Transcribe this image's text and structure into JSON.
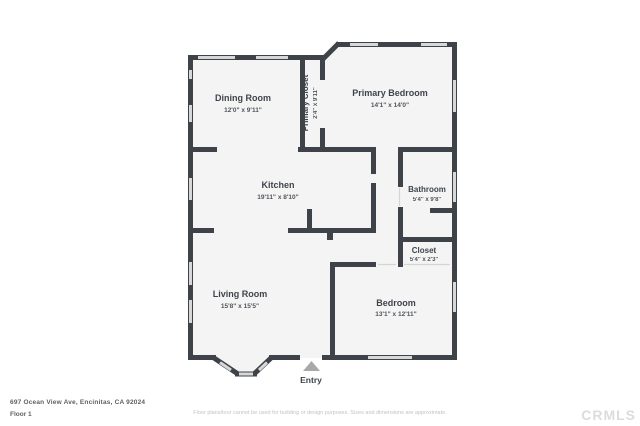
{
  "meta": {
    "address": "697 Ocean View Ave, Encinitas, CA 92024",
    "floor_label": "Floor 1",
    "disclaimer": "Floor plans/tour cannot be used for building or design purposes. Sizes and dimensions are approximate.",
    "watermark": "CRMLS"
  },
  "colors": {
    "wall": "#3e434a",
    "floor": "#f4f4f4",
    "window": "#d8d8d8",
    "label": "#3f444b",
    "entry_marker": "#a8a8a8",
    "disclaimer": "#c2c2c2",
    "watermark": "#dcdcdc"
  },
  "rooms": {
    "dining": {
      "name": "Dining Room",
      "dims": "12'0\" x 9'11\""
    },
    "primary_closet": {
      "name": "Primary Closet",
      "dims": "2'4\" x 9'11\""
    },
    "primary_bedroom": {
      "name": "Primary Bedroom",
      "dims": "14'1\" x 14'0\""
    },
    "kitchen": {
      "name": "Kitchen",
      "dims": "19'11\" x 8'10\""
    },
    "bathroom": {
      "name": "Bathroom",
      "dims": "5'4\" x 9'8\""
    },
    "closet": {
      "name": "Closet",
      "dims": "5'4\" x 2'3\""
    },
    "living": {
      "name": "Living Room",
      "dims": "15'8\" x 15'5\""
    },
    "bedroom": {
      "name": "Bedroom",
      "dims": "13'1\" x 12'11\""
    },
    "entry": {
      "name": "Entry"
    }
  }
}
